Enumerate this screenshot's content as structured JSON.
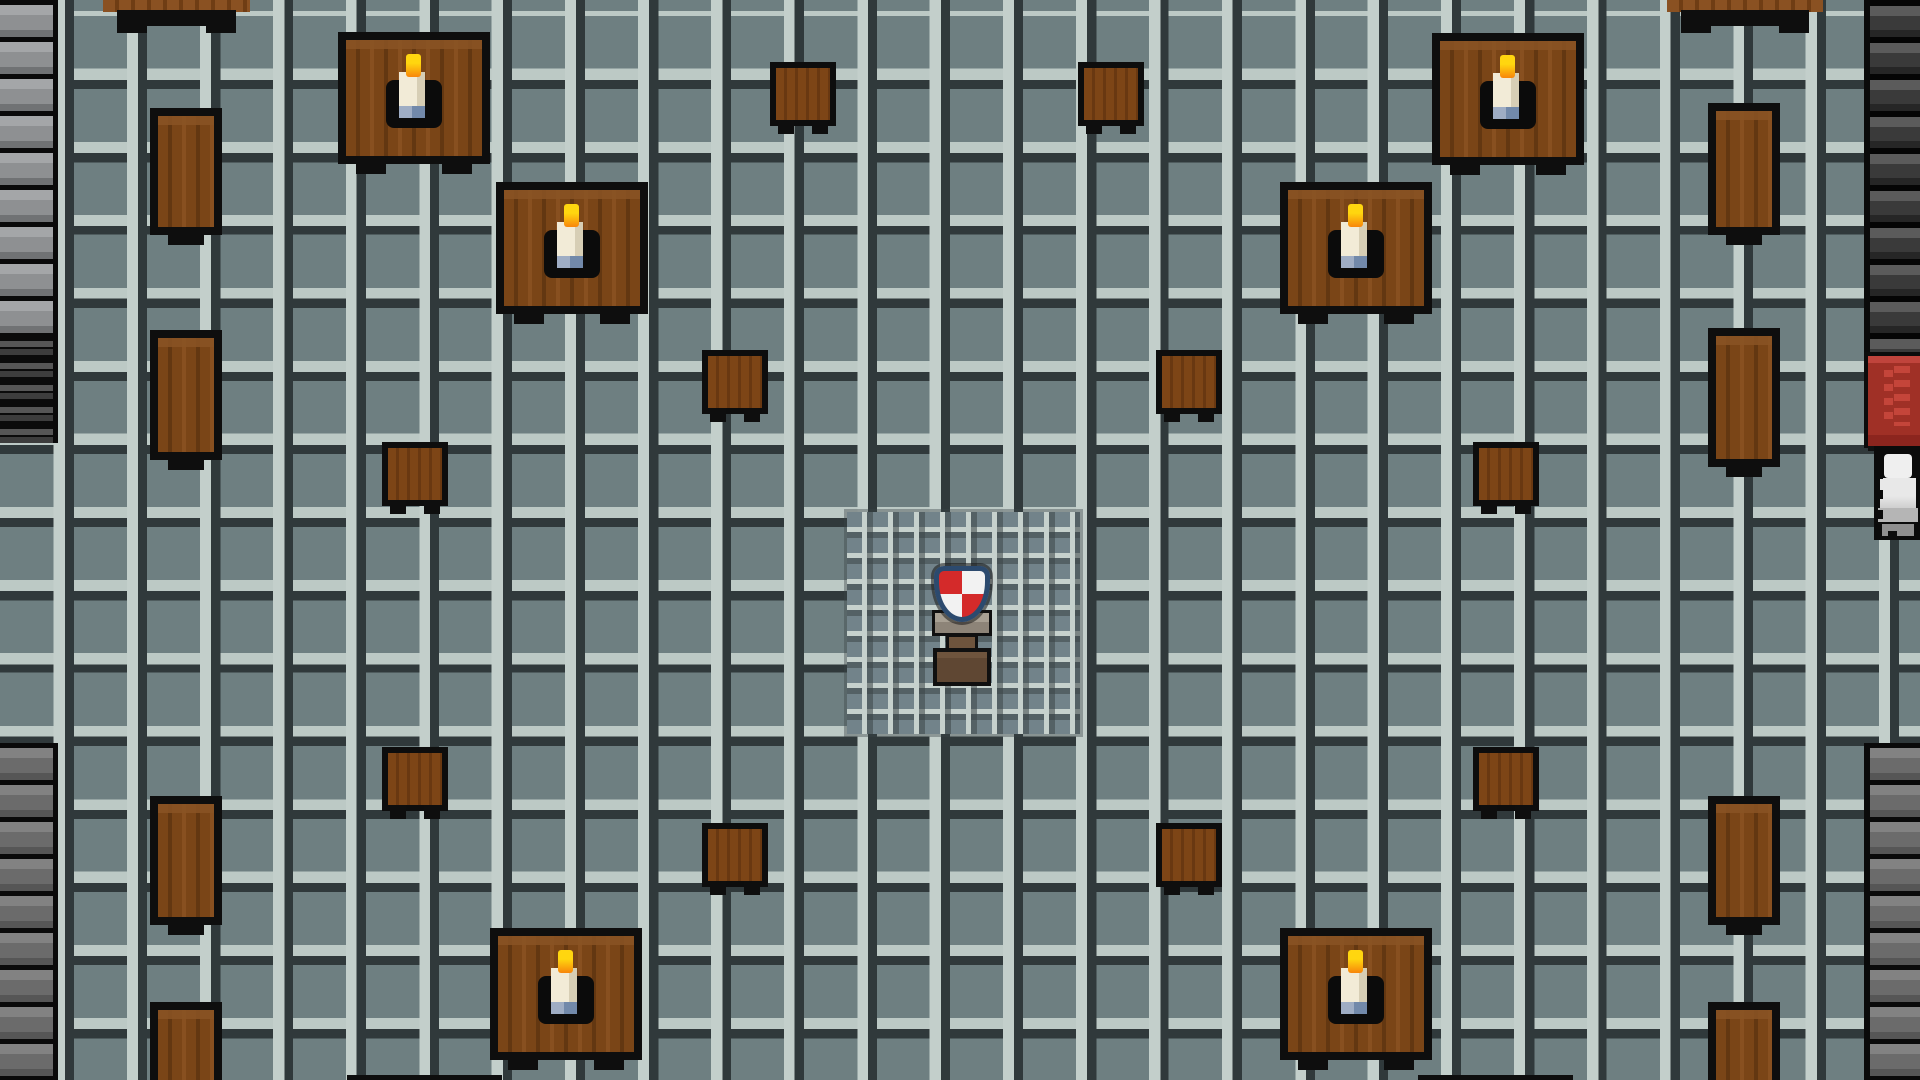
{
  "scene": {
    "type": "game-map-screenshot",
    "style": "pixel-art RPG interior (great hall / mess hall)",
    "width": 1920,
    "height": 1080,
    "visible_text": [],
    "hud": "none"
  },
  "palette": {
    "floor_base": "#6e7f81",
    "floor_grid_dark": "#30393b",
    "floor_grid_light": "#c3cfcb",
    "fine_grid_base": "#72838a",
    "wall_gray_brick": "#8e9092",
    "wall_gray2_brick": "#6b6b6b",
    "wall_dark_brick": "#3a3a3a",
    "mortar_black": "#0a0a0a",
    "wood_table": "#7a4517",
    "wood_dark": "#633711",
    "wood_light_band": "#8a5424",
    "outline_black": "#0e0e0e",
    "candle_flame_top": "#ffd60f",
    "candle_flame_bottom": "#f8860b",
    "candle_body": "#f2ebd7",
    "candle_base_blue": "#7289aa",
    "banner_red": "#a03026",
    "banner_red_light": "#c4453a",
    "shield_red": "#d42a2a",
    "shield_white": "#f2f2f2",
    "shield_border_navy": "#2c4a6e",
    "pedestal_stone": "#8d8478",
    "pedestal_wood": "#5f4733",
    "statue_light": "#efefef"
  },
  "regions": {
    "floor": {
      "x": 0,
      "y": 0,
      "w": 1920,
      "h": 1080
    },
    "fine_grid": {
      "x": 847,
      "y": 512,
      "w": 233,
      "h": 222
    }
  },
  "walls": [
    {
      "name": "left-wall-top",
      "variant": "gray",
      "x": 0,
      "y": 0,
      "w": 58,
      "h": 333
    },
    {
      "name": "left-wall-slats",
      "variant": "slats",
      "x": 0,
      "y": 333,
      "w": 58,
      "h": 110
    },
    {
      "name": "left-wall-bottom",
      "variant": "gray2",
      "x": 0,
      "y": 743,
      "w": 58,
      "h": 337
    },
    {
      "name": "right-wall-top",
      "variant": "dark rightside",
      "x": 1864,
      "y": 0,
      "w": 56,
      "h": 352
    },
    {
      "name": "right-wall-recess",
      "variant": "black",
      "x": 1864,
      "y": 352,
      "w": 56,
      "h": 96
    },
    {
      "name": "right-wall-bottom",
      "variant": "gray2 rightside",
      "x": 1864,
      "y": 743,
      "w": 56,
      "h": 337
    }
  ],
  "furniture": [
    {
      "type": "big-table",
      "name": "table-topleft-outer",
      "x": 338,
      "y": 32,
      "w": 152,
      "h": 132,
      "candle": true
    },
    {
      "type": "big-table",
      "name": "table-topleft-inner",
      "x": 496,
      "y": 182,
      "w": 152,
      "h": 132,
      "candle": true
    },
    {
      "type": "big-table",
      "name": "table-topright-outer",
      "x": 1432,
      "y": 33,
      "w": 152,
      "h": 132,
      "candle": true
    },
    {
      "type": "big-table",
      "name": "table-topright-inner",
      "x": 1280,
      "y": 182,
      "w": 152,
      "h": 132,
      "candle": true
    },
    {
      "type": "big-table",
      "name": "table-bottomleft",
      "x": 490,
      "y": 928,
      "w": 152,
      "h": 132,
      "candle": true
    },
    {
      "type": "big-table",
      "name": "table-bottomright",
      "x": 1280,
      "y": 928,
      "w": 152,
      "h": 132,
      "candle": true
    },
    {
      "type": "narrow-table",
      "name": "sidetable-left-1",
      "x": 150,
      "y": 108,
      "w": 72,
      "h": 127
    },
    {
      "type": "narrow-table",
      "name": "sidetable-left-2",
      "x": 150,
      "y": 330,
      "w": 72,
      "h": 130
    },
    {
      "type": "narrow-table",
      "name": "sidetable-left-3",
      "x": 150,
      "y": 796,
      "w": 72,
      "h": 129
    },
    {
      "type": "narrow-table",
      "name": "sidetable-left-4",
      "x": 150,
      "y": 1002,
      "w": 72,
      "h": 90,
      "cut": true
    },
    {
      "type": "narrow-table",
      "name": "sidetable-right-1",
      "x": 1708,
      "y": 103,
      "w": 72,
      "h": 132
    },
    {
      "type": "narrow-table",
      "name": "sidetable-right-2",
      "x": 1708,
      "y": 328,
      "w": 72,
      "h": 139
    },
    {
      "type": "narrow-table",
      "name": "sidetable-right-3",
      "x": 1708,
      "y": 796,
      "w": 72,
      "h": 129
    },
    {
      "type": "narrow-table",
      "name": "sidetable-right-4",
      "x": 1708,
      "y": 1002,
      "w": 72,
      "h": 90,
      "cut": true
    },
    {
      "type": "stool",
      "name": "stool-top-left",
      "x": 770,
      "y": 62,
      "w": 66,
      "h": 64
    },
    {
      "type": "stool",
      "name": "stool-top-right",
      "x": 1078,
      "y": 62,
      "w": 66,
      "h": 64
    },
    {
      "type": "stool",
      "name": "stool-mid-left-outer",
      "x": 702,
      "y": 350,
      "w": 66,
      "h": 64
    },
    {
      "type": "stool",
      "name": "stool-mid-right-outer",
      "x": 1156,
      "y": 350,
      "w": 66,
      "h": 64
    },
    {
      "type": "stool",
      "name": "stool-mid-left-inner",
      "x": 382,
      "y": 442,
      "w": 66,
      "h": 64
    },
    {
      "type": "stool",
      "name": "stool-mid-right-inner",
      "x": 1473,
      "y": 442,
      "w": 66,
      "h": 64
    },
    {
      "type": "stool",
      "name": "stool-bottom-left-inner",
      "x": 382,
      "y": 747,
      "w": 66,
      "h": 64
    },
    {
      "type": "stool",
      "name": "stool-bottom-right-inner",
      "x": 1473,
      "y": 747,
      "w": 66,
      "h": 64
    },
    {
      "type": "stool",
      "name": "stool-bottom-left-outer",
      "x": 702,
      "y": 823,
      "w": 66,
      "h": 64
    },
    {
      "type": "stool",
      "name": "stool-bottom-right-outer",
      "x": 1156,
      "y": 823,
      "w": 66,
      "h": 64
    },
    {
      "type": "table-edge-top",
      "name": "cut-table-top-left",
      "x": 103,
      "y": 0,
      "w": 147,
      "h": 33
    },
    {
      "type": "table-edge-top",
      "name": "cut-table-top-right",
      "x": 1667,
      "y": 0,
      "w": 156,
      "h": 33
    },
    {
      "type": "table-edge-bottom",
      "name": "cut-table-bottom-left",
      "x": 347,
      "y": 1075,
      "w": 155,
      "h": 5
    },
    {
      "type": "table-edge-bottom",
      "name": "cut-table-bottom-right",
      "x": 1418,
      "y": 1075,
      "w": 155,
      "h": 5
    }
  ],
  "props": {
    "banner": {
      "name": "red-wall-banner",
      "x": 1868,
      "y": 356,
      "w": 52,
      "h": 90
    },
    "statue": {
      "name": "armor-statue",
      "x": 1874,
      "y": 446,
      "w": 46,
      "h": 94
    },
    "pedestal": {
      "name": "shield-pedestal",
      "x": 920,
      "y": 560,
      "w": 84,
      "h": 130,
      "shield": {
        "x": 14,
        "y": 6,
        "w": 56,
        "h": 56
      },
      "top": {
        "x": 12,
        "y": 50,
        "w": 60,
        "h": 26
      },
      "neck": {
        "x": 26,
        "y": 74,
        "w": 32,
        "h": 18
      },
      "foot": {
        "x": 13,
        "y": 88,
        "w": 58,
        "h": 38
      }
    }
  }
}
